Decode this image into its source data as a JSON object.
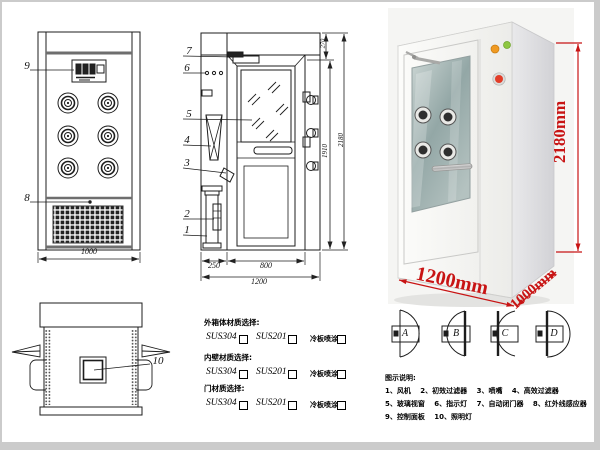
{
  "front_view": {
    "callout_9": "9",
    "callout_8": "8",
    "dim_width": "1000"
  },
  "section_view": {
    "callout_7": "7",
    "callout_6": "6",
    "callout_5": "5",
    "callout_4": "4",
    "callout_3": "3",
    "callout_2": "2",
    "callout_1": "1",
    "dim_top": "270",
    "dim_door_height": "1910",
    "dim_total_height": "2180",
    "dim_left": "250",
    "dim_door_width": "800",
    "dim_total_width": "1200"
  },
  "top_view": {
    "callout_10": "10"
  },
  "photo": {
    "height_label": "2180mm",
    "width_label": "1200mm",
    "depth_label": "1000mm"
  },
  "materials": {
    "sections": [
      {
        "title": "外箱体材质选择:",
        "options": [
          "SUS304",
          "SUS201",
          "冷板喷涂"
        ]
      },
      {
        "title": "内壁材质选择:",
        "options": [
          "SUS304",
          "SUS201",
          "冷板喷涂"
        ]
      },
      {
        "title": "门材质选择:",
        "options": [
          "SUS304",
          "SUS201",
          "冷板喷涂"
        ]
      }
    ]
  },
  "door_styles": {
    "labels": [
      "A",
      "B",
      "C",
      "D"
    ]
  },
  "legend": {
    "title": "图示说明:",
    "lines": [
      "1、风机　 2、初效过滤器　 3、喷嘴　 4、高效过滤器",
      "5、玻璃视窗　 6、指示灯　 7、自动闭门器　 8、红外线感应器",
      "9、控制面板　 10、照明灯"
    ]
  },
  "colors": {
    "dim_red": "#c81414",
    "line_black": "#1c1c1c",
    "frame_gray": "#c9c9c9"
  }
}
